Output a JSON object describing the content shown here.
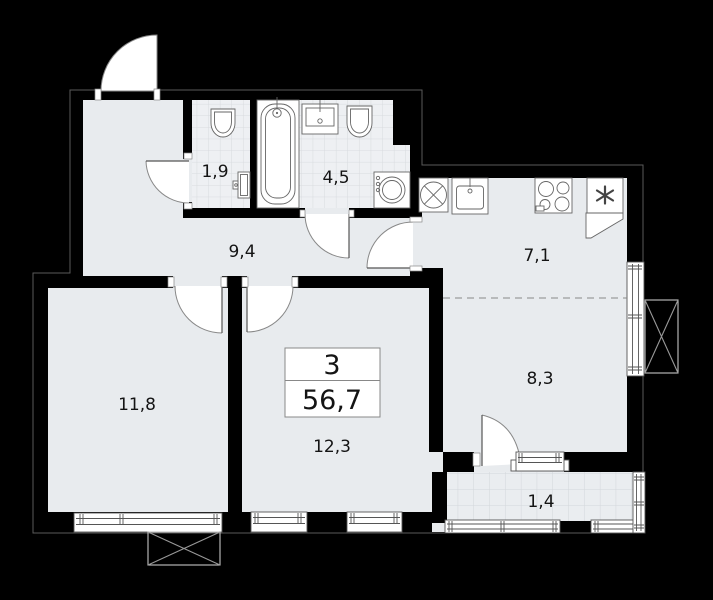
{
  "page": {
    "kind": "apartment-floor-plan",
    "background": "#000000"
  },
  "colors": {
    "floor": "#e8ebee",
    "tile_fill": "#eef0f3",
    "tile_line": "#d8dbdf",
    "wall": "#000000",
    "fixture_line": "#666666",
    "building_outline": "#5a5a5a",
    "fixture_fill": "#ffffff",
    "text": "#141414"
  },
  "summary": {
    "rooms_count": "3",
    "total_area": "56,7"
  },
  "rooms": [
    {
      "id": "wc",
      "label": "1,9"
    },
    {
      "id": "bathroom",
      "label": "4,5"
    },
    {
      "id": "hallway",
      "label": "9,4"
    },
    {
      "id": "kitchen",
      "label": "7,1"
    },
    {
      "id": "living",
      "label": "8,3"
    },
    {
      "id": "bedroom1",
      "label": "11,8"
    },
    {
      "id": "bedroom2",
      "label": "12,3"
    },
    {
      "id": "balcony",
      "label": "1,4"
    }
  ],
  "icons": {
    "refrigerator-icon": "✳",
    "ventilation-icon": "circle-with-cross",
    "ac-basket-icon": "rect-with-diagonals"
  }
}
